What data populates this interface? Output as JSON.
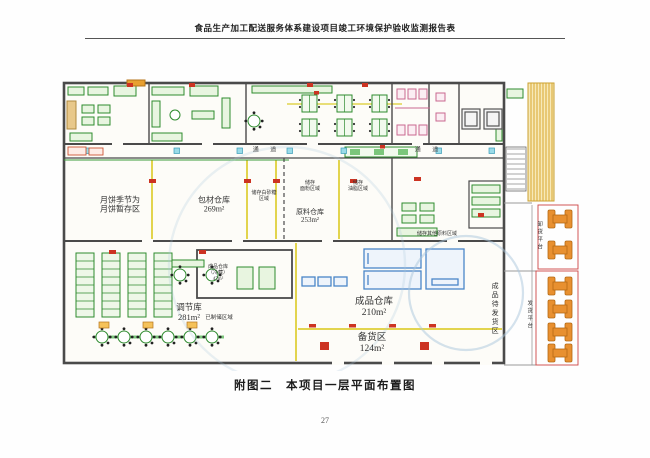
{
  "page": {
    "header": "食品生产加工配送服务体系建设项目竣工环境保护验收监测报告表",
    "caption": "附图二　本项目一层平面布置图",
    "page_number": "27"
  },
  "plan": {
    "corridors": {
      "left": "通 道",
      "right": "通 道"
    },
    "labels": {
      "mooncake_line1": "月饼季节为",
      "mooncake_line2": "月饼暂存区",
      "packaging_name": "包材仓库",
      "packaging_area": "269m²",
      "sugar_zone": "储存白砂糖区域",
      "flour_line1": "储存",
      "flour_line2": "面粉区域",
      "oil_line1": "储存",
      "oil_line2": "油脂区域",
      "raw_name": "原料仓库",
      "raw_area": "253m²",
      "other_raw_zone": "储存其他原料区域",
      "adjust_name": "调节库",
      "adjust_area": "281m²",
      "finished_cold_line1": "成品仓库",
      "finished_cold_line2": "（冷藏）",
      "finished_cold_area": "47m²",
      "stored_zone": "已制储区域",
      "finished_name": "成品仓库",
      "finished_area": "210m²",
      "stock_name": "备货区",
      "stock_area": "124m²",
      "awaiting_zone": "成品待发货区",
      "ship_platform": "发货平台",
      "unload_platform": "卸货平台"
    },
    "colors": {
      "wall": "#4a4a4a",
      "equipment_green": "#2e8b2e",
      "column_yellow": "#e2d44e",
      "cold_blue": "#4a86c8",
      "marker_red": "#cc3322",
      "truck_orange": "#e89030",
      "fixture_pink": "#c9688f",
      "watermark_blue": "#aac6dc"
    }
  }
}
